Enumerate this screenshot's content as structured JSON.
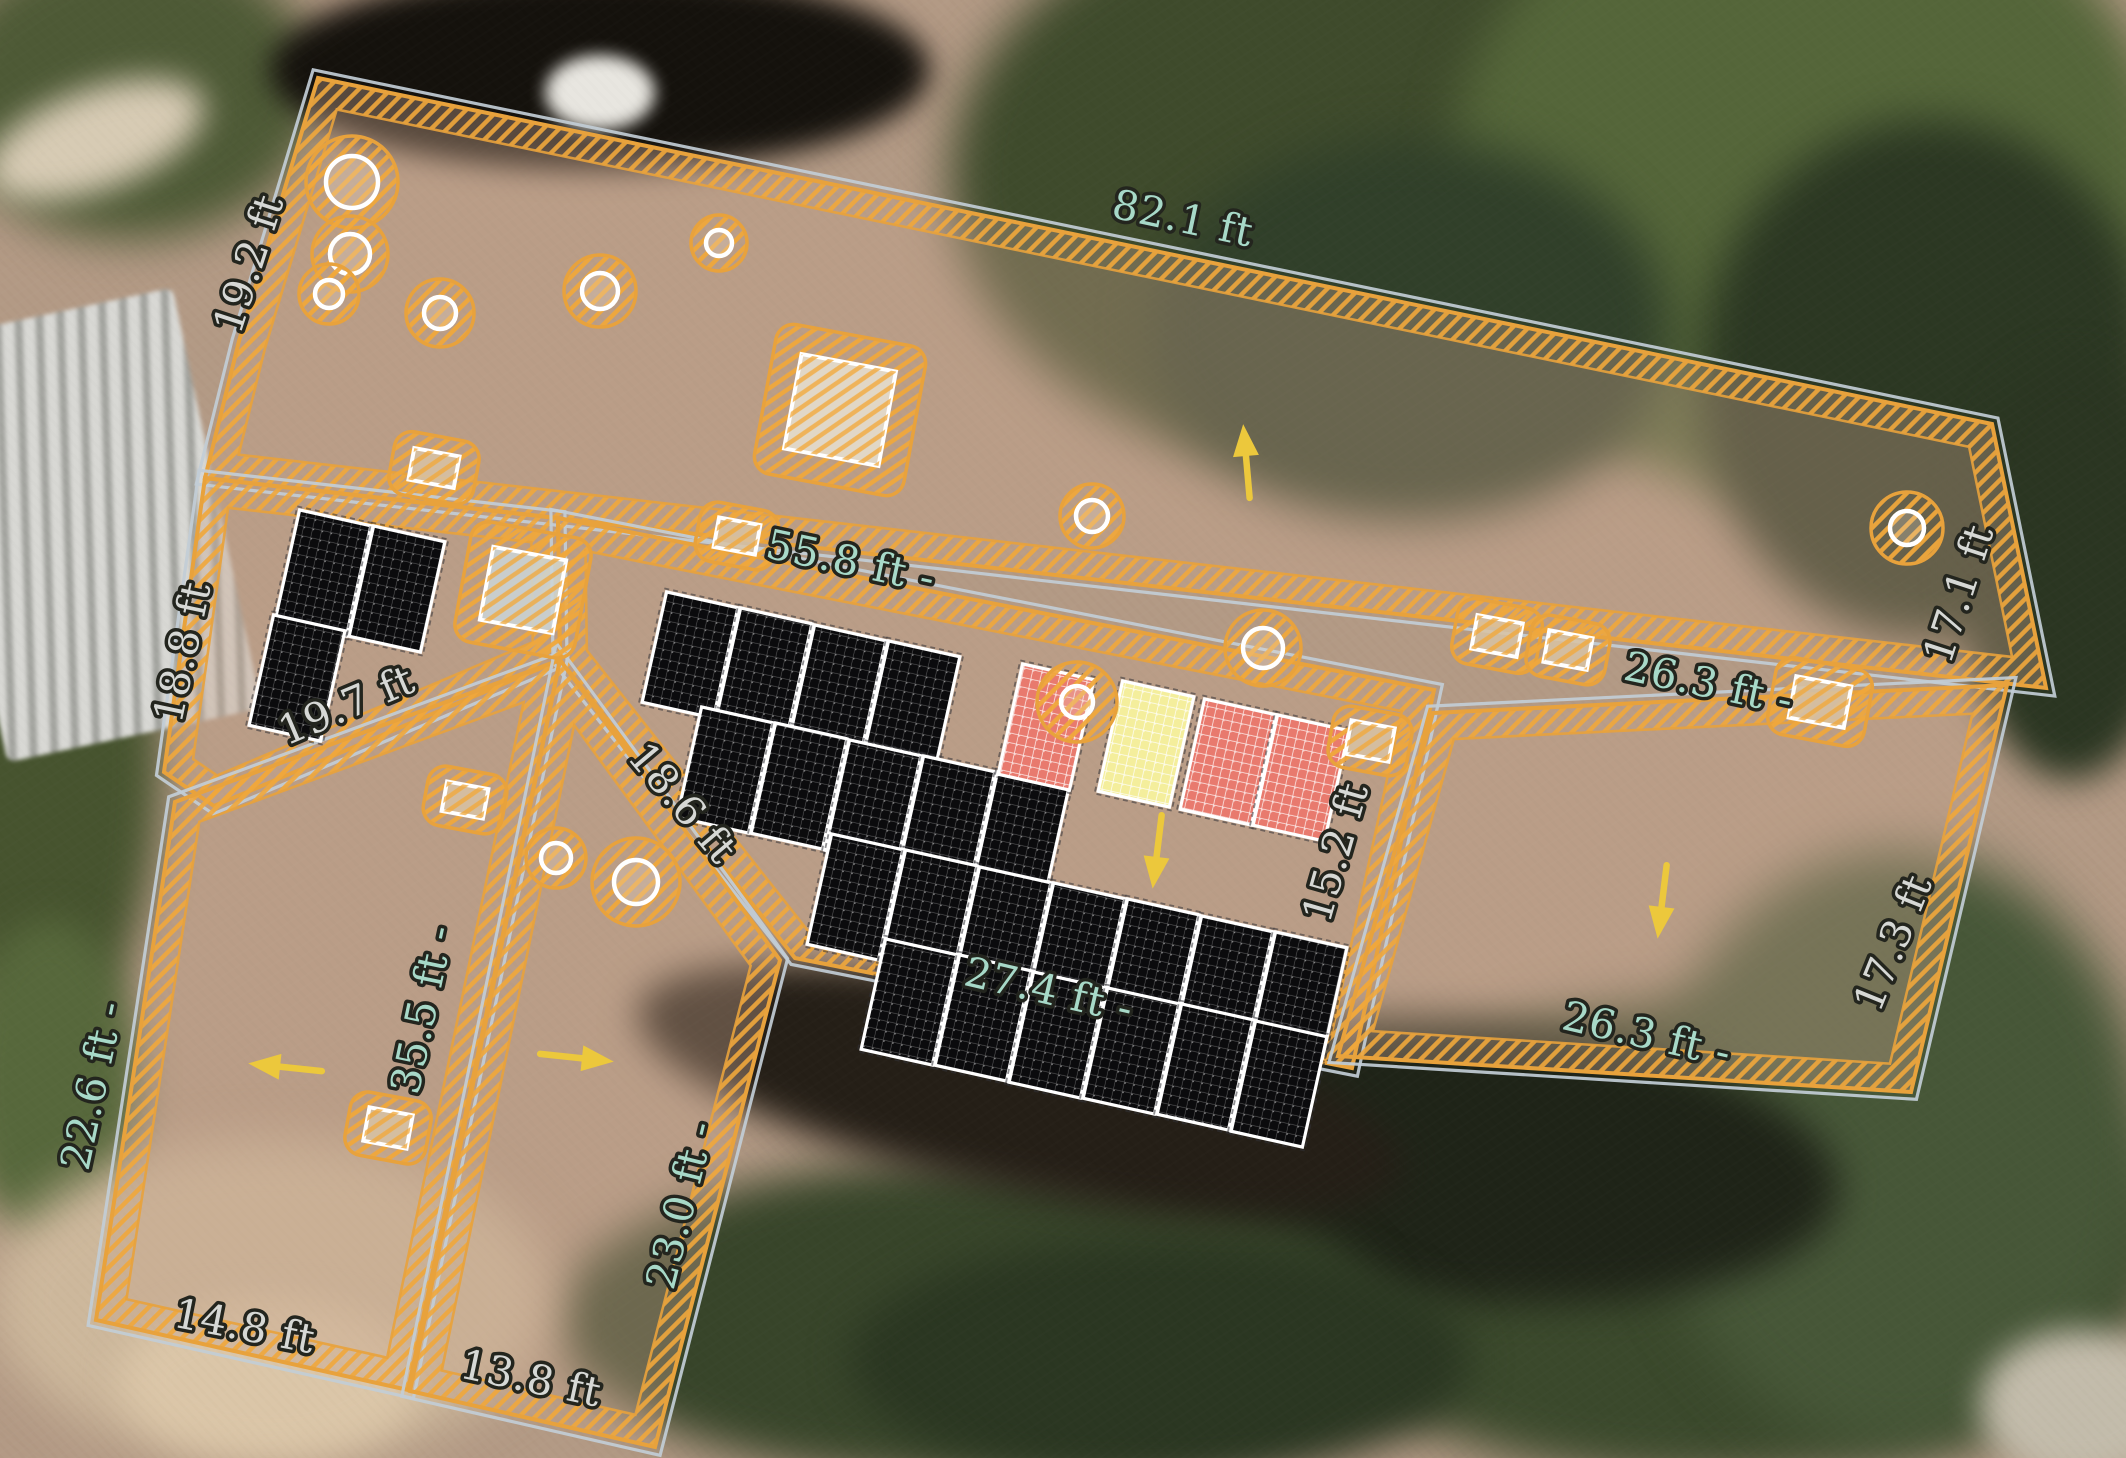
{
  "app": {
    "name": "solar-roof-design-canvas"
  },
  "canvas": {
    "w": 2126,
    "h": 1458
  },
  "colors": {
    "outline_orange": "#E8A23C",
    "hatch_orange": "#F0A73B",
    "eave_gray": "#C2CDD6",
    "label_teal": "#A7D9C8",
    "label_white": "#D6D8D5",
    "label_halo": "#23251e",
    "panel_black": "#0B0B0D",
    "panel_cell_line": "rgba(255,255,255,0.30)",
    "panel_red": "#E87A6E",
    "panel_yellow": "#F4EE9C",
    "panel_border": "#FFFFFF",
    "arrow_yellow": "#ECC83C",
    "roof_tint": "rgba(198,164,140,0.38)",
    "obstruction_light": "#E8E2D2",
    "obstruction_gray": "#CBD6D8",
    "obstruction_tan": "#D8C3A4"
  },
  "roof": {
    "planes": [
      {
        "name": "north-main",
        "points": [
          [
            318,
            78
          ],
          [
            1992,
            424
          ],
          [
            2046,
            688
          ],
          [
            205,
            478
          ],
          [
            239,
            341
          ]
        ]
      },
      {
        "name": "west-mid",
        "points": [
          [
            205,
            478
          ],
          [
            558,
            518
          ],
          [
            560,
            660
          ],
          [
            214,
            806
          ],
          [
            164,
            772
          ]
        ]
      },
      {
        "name": "center-main",
        "points": [
          [
            558,
            518
          ],
          [
            1434,
            690
          ],
          [
            1352,
            1068
          ],
          [
            795,
            958
          ],
          [
            560,
            660
          ]
        ]
      },
      {
        "name": "southeast",
        "points": [
          [
            1433,
            713
          ],
          [
            2007,
            685
          ],
          [
            1911,
            1092
          ],
          [
            1338,
            1056
          ]
        ]
      },
      {
        "name": "southwest-left",
        "points": [
          [
            560,
            660
          ],
          [
            408,
            1390
          ],
          [
            96,
            1320
          ],
          [
            175,
            802
          ]
        ]
      },
      {
        "name": "southwest-right",
        "points": [
          [
            560,
            660
          ],
          [
            780,
            960
          ],
          [
            655,
            1447
          ],
          [
            410,
            1391
          ]
        ]
      }
    ]
  },
  "measurements": [
    {
      "text": "82.1 ft",
      "x": 1180,
      "y": 232,
      "rot": 12,
      "tone": "teal"
    },
    {
      "text": "19.2 ft",
      "x": 262,
      "y": 268,
      "rot": -72,
      "tone": "white"
    },
    {
      "text": "55.8 ft -",
      "x": 848,
      "y": 575,
      "rot": 12,
      "tone": "teal"
    },
    {
      "text": "18.8 ft",
      "x": 196,
      "y": 655,
      "rot": -78,
      "tone": "white"
    },
    {
      "text": "19.7 ft",
      "x": 352,
      "y": 718,
      "rot": -23,
      "tone": "white"
    },
    {
      "text": "18.6 ft",
      "x": 672,
      "y": 812,
      "rot": 50,
      "tone": "white"
    },
    {
      "text": "17.1 ft",
      "x": 1972,
      "y": 598,
      "rot": -72,
      "tone": "white"
    },
    {
      "text": "26.3 ft -",
      "x": 1706,
      "y": 697,
      "rot": 12,
      "tone": "teal"
    },
    {
      "text": "15.2 ft",
      "x": 1349,
      "y": 856,
      "rot": -74,
      "tone": "white"
    },
    {
      "text": "17.3 ft",
      "x": 1906,
      "y": 948,
      "rot": -68,
      "tone": "white"
    },
    {
      "text": "26.3 ft -",
      "x": 1644,
      "y": 1048,
      "rot": 13,
      "tone": "teal"
    },
    {
      "text": "27.4 ft -",
      "x": 1046,
      "y": 1004,
      "rot": 13,
      "tone": "teal"
    },
    {
      "text": "22.6 ft -",
      "x": 106,
      "y": 1088,
      "rot": -78,
      "tone": "teal"
    },
    {
      "text": "35.5 ft -",
      "x": 436,
      "y": 1012,
      "rot": -78,
      "tone": "teal"
    },
    {
      "text": "23.0 ft -",
      "x": 694,
      "y": 1208,
      "rot": -76,
      "tone": "teal"
    },
    {
      "text": "14.8 ft",
      "x": 242,
      "y": 1340,
      "rot": 11,
      "tone": "white"
    },
    {
      "text": "13.8 ft",
      "x": 528,
      "y": 1392,
      "rot": 12,
      "tone": "white"
    }
  ],
  "panels": {
    "tilt_deg": 12.5,
    "w": 73,
    "h": 113,
    "items": [
      {
        "x": 323,
        "y": 573,
        "c": "black"
      },
      {
        "x": 397,
        "y": 589,
        "c": "black"
      },
      {
        "x": 297,
        "y": 678,
        "c": "black"
      },
      {
        "x": 690,
        "y": 655,
        "c": "black"
      },
      {
        "x": 764,
        "y": 671,
        "c": "black"
      },
      {
        "x": 838,
        "y": 688,
        "c": "black"
      },
      {
        "x": 912,
        "y": 704,
        "c": "black"
      },
      {
        "x": 725,
        "y": 770,
        "c": "black"
      },
      {
        "x": 799,
        "y": 786,
        "c": "black"
      },
      {
        "x": 873,
        "y": 803,
        "c": "black"
      },
      {
        "x": 947,
        "y": 819,
        "c": "black"
      },
      {
        "x": 1021,
        "y": 835,
        "c": "black"
      },
      {
        "x": 855,
        "y": 897,
        "c": "black"
      },
      {
        "x": 929,
        "y": 913,
        "c": "black"
      },
      {
        "x": 1003,
        "y": 930,
        "c": "black"
      },
      {
        "x": 1077,
        "y": 946,
        "c": "black"
      },
      {
        "x": 1151,
        "y": 962,
        "c": "black"
      },
      {
        "x": 1225,
        "y": 979,
        "c": "black"
      },
      {
        "x": 1299,
        "y": 995,
        "c": "black"
      },
      {
        "x": 909,
        "y": 1002,
        "c": "black"
      },
      {
        "x": 983,
        "y": 1018,
        "c": "black"
      },
      {
        "x": 1057,
        "y": 1035,
        "c": "black"
      },
      {
        "x": 1131,
        "y": 1051,
        "c": "black"
      },
      {
        "x": 1205,
        "y": 1067,
        "c": "black"
      },
      {
        "x": 1279,
        "y": 1084,
        "c": "black"
      },
      {
        "x": 1046,
        "y": 727,
        "c": "red"
      },
      {
        "x": 1146,
        "y": 744,
        "c": "yellow"
      },
      {
        "x": 1228,
        "y": 762,
        "c": "red"
      },
      {
        "x": 1301,
        "y": 778,
        "c": "red"
      }
    ]
  },
  "obstructions": {
    "circles": [
      {
        "x": 352,
        "y": 182,
        "r": 26,
        "keep": 46
      },
      {
        "x": 350,
        "y": 254,
        "r": 20,
        "keep": 38
      },
      {
        "x": 329,
        "y": 294,
        "r": 14,
        "keep": 30
      },
      {
        "x": 440,
        "y": 313,
        "r": 16,
        "keep": 34
      },
      {
        "x": 600,
        "y": 291,
        "r": 18,
        "keep": 36
      },
      {
        "x": 719,
        "y": 243,
        "r": 13,
        "keep": 28
      },
      {
        "x": 1092,
        "y": 516,
        "r": 16,
        "keep": 32
      },
      {
        "x": 1263,
        "y": 648,
        "r": 20,
        "keep": 38
      },
      {
        "x": 1077,
        "y": 702,
        "r": 16,
        "keep": 40
      },
      {
        "x": 1907,
        "y": 528,
        "r": 17,
        "keep": 36
      },
      {
        "x": 636,
        "y": 882,
        "r": 22,
        "keep": 44
      },
      {
        "x": 556,
        "y": 858,
        "r": 15,
        "keep": 30
      }
    ],
    "rects": [
      {
        "x": 840,
        "y": 410,
        "w": 96,
        "h": 96,
        "kw": 152,
        "kh": 152,
        "fill": "light"
      },
      {
        "x": 523,
        "y": 590,
        "w": 74,
        "h": 74,
        "kw": 122,
        "kh": 122,
        "fill": "gray"
      },
      {
        "x": 434,
        "y": 468,
        "w": 46,
        "h": 32,
        "kw": 86,
        "kh": 64,
        "fill": "tan"
      },
      {
        "x": 737,
        "y": 536,
        "w": 42,
        "h": 30,
        "kw": 80,
        "kh": 60,
        "fill": "tan"
      },
      {
        "x": 465,
        "y": 800,
        "w": 42,
        "h": 30,
        "kw": 80,
        "kh": 60,
        "fill": "tan"
      },
      {
        "x": 388,
        "y": 1128,
        "w": 44,
        "h": 34,
        "kw": 82,
        "kh": 64,
        "fill": "tan"
      },
      {
        "x": 1497,
        "y": 636,
        "w": 46,
        "h": 34,
        "kw": 86,
        "kh": 66,
        "fill": "tan"
      },
      {
        "x": 1568,
        "y": 650,
        "w": 44,
        "h": 32,
        "kw": 80,
        "kh": 62,
        "fill": "tan"
      },
      {
        "x": 1820,
        "y": 702,
        "w": 56,
        "h": 42,
        "kw": 98,
        "kh": 78,
        "fill": "tan"
      },
      {
        "x": 1370,
        "y": 741,
        "w": 44,
        "h": 34,
        "kw": 80,
        "kh": 62,
        "fill": "tan"
      }
    ]
  },
  "arrows": [
    {
      "x": 1247,
      "y": 468,
      "dir": -95
    },
    {
      "x": 1158,
      "y": 845,
      "dir": 97
    },
    {
      "x": 1663,
      "y": 895,
      "dir": 97
    },
    {
      "x": 292,
      "y": 1068,
      "dir": 186
    },
    {
      "x": 570,
      "y": 1057,
      "dir": 6
    }
  ]
}
